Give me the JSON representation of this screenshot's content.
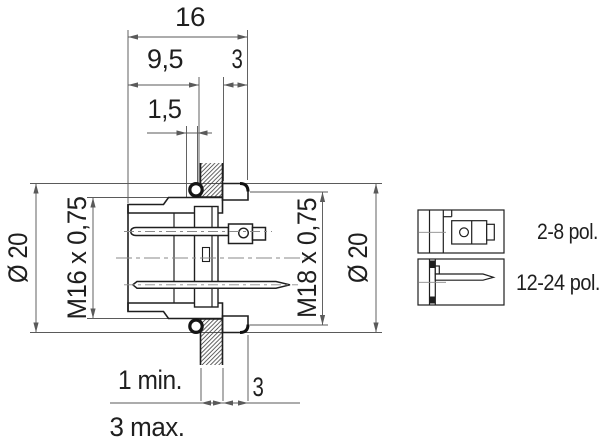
{
  "title": "Male panel mount connector - dimensional drawing",
  "dims": {
    "overall_width": "16",
    "front_length": "9,5",
    "nut_width_top": "3",
    "groove_width": "1,5",
    "front_diameter": "Ø 20",
    "front_thread": "M16 x 0,75",
    "rear_thread": "M18 x 0,75",
    "rear_diameter": "Ø 20",
    "panel_thickness_min": "1 min.",
    "nut_width_bottom": "3",
    "panel_thickness_max": "3 max."
  },
  "variants": [
    {
      "label": "2-8 pol."
    },
    {
      "label": "12-24 pol."
    }
  ],
  "colors": {
    "line": "#1f1f1f",
    "dimension": "#5a5a5a",
    "centerline": "#8a8a8a",
    "background": "#ffffff"
  }
}
